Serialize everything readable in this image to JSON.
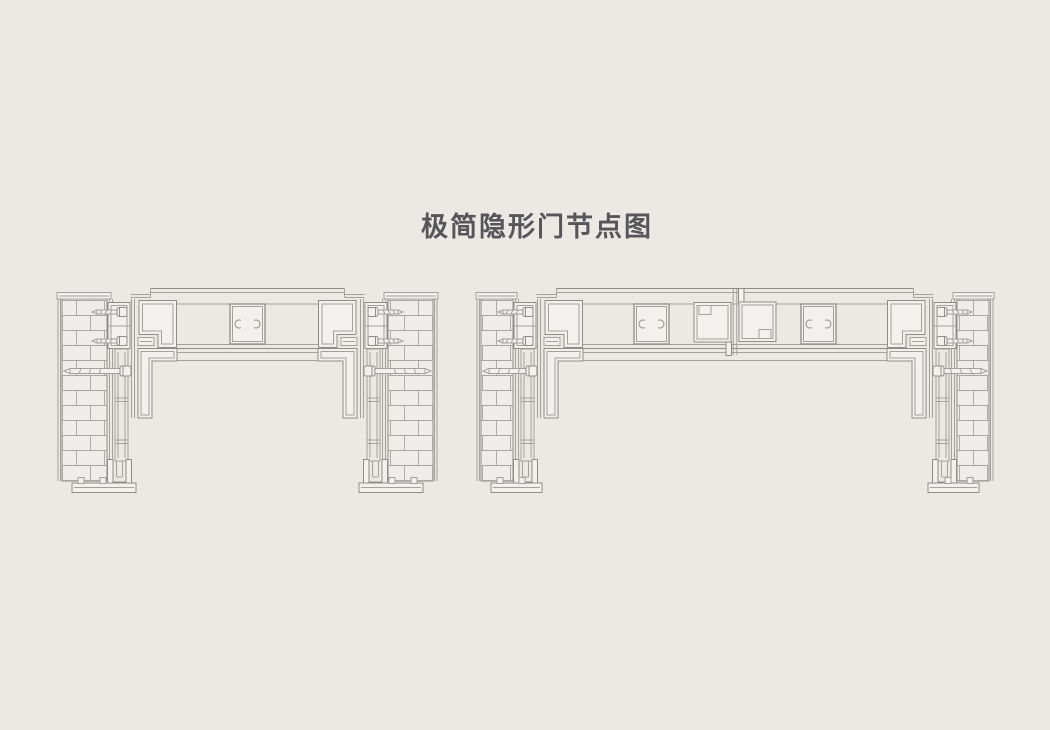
{
  "title": {
    "text": "极简隐形门节点图"
  },
  "colors": {
    "background": "#ebe9e4",
    "line": "#a3a19d",
    "line_strong": "#8f8d89",
    "brick_line": "#a8a6a2",
    "profile_fill": "#f2f1ee",
    "wall_fill": "#efede9",
    "title_text": "#56565a"
  },
  "canvas": {
    "width": 1050,
    "height": 730
  },
  "diagrams": [
    {
      "id": "single-door-node-detail",
      "label": "single door leaf node section",
      "axis_x": 247.5,
      "wall_inner_x": 107,
      "wall_width": 45,
      "wall_top_y": 299,
      "wall_bottom_y": 481,
      "anchor_screw_ys": [
        312,
        341
      ],
      "long_screw_y": 371,
      "block_offsets": [
        0
      ],
      "meeting_stiles": false
    },
    {
      "id": "double-door-node-detail",
      "label": "double door leaf node section",
      "axis_x": 735,
      "wall_inner_x": 513,
      "wall_width": 32,
      "wall_top_y": 299,
      "wall_bottom_y": 481,
      "anchor_screw_ys": [
        312,
        341
      ],
      "long_screw_y": 371,
      "block_offsets": [
        -83.5,
        83.5
      ],
      "meeting_stiles": true
    }
  ]
}
